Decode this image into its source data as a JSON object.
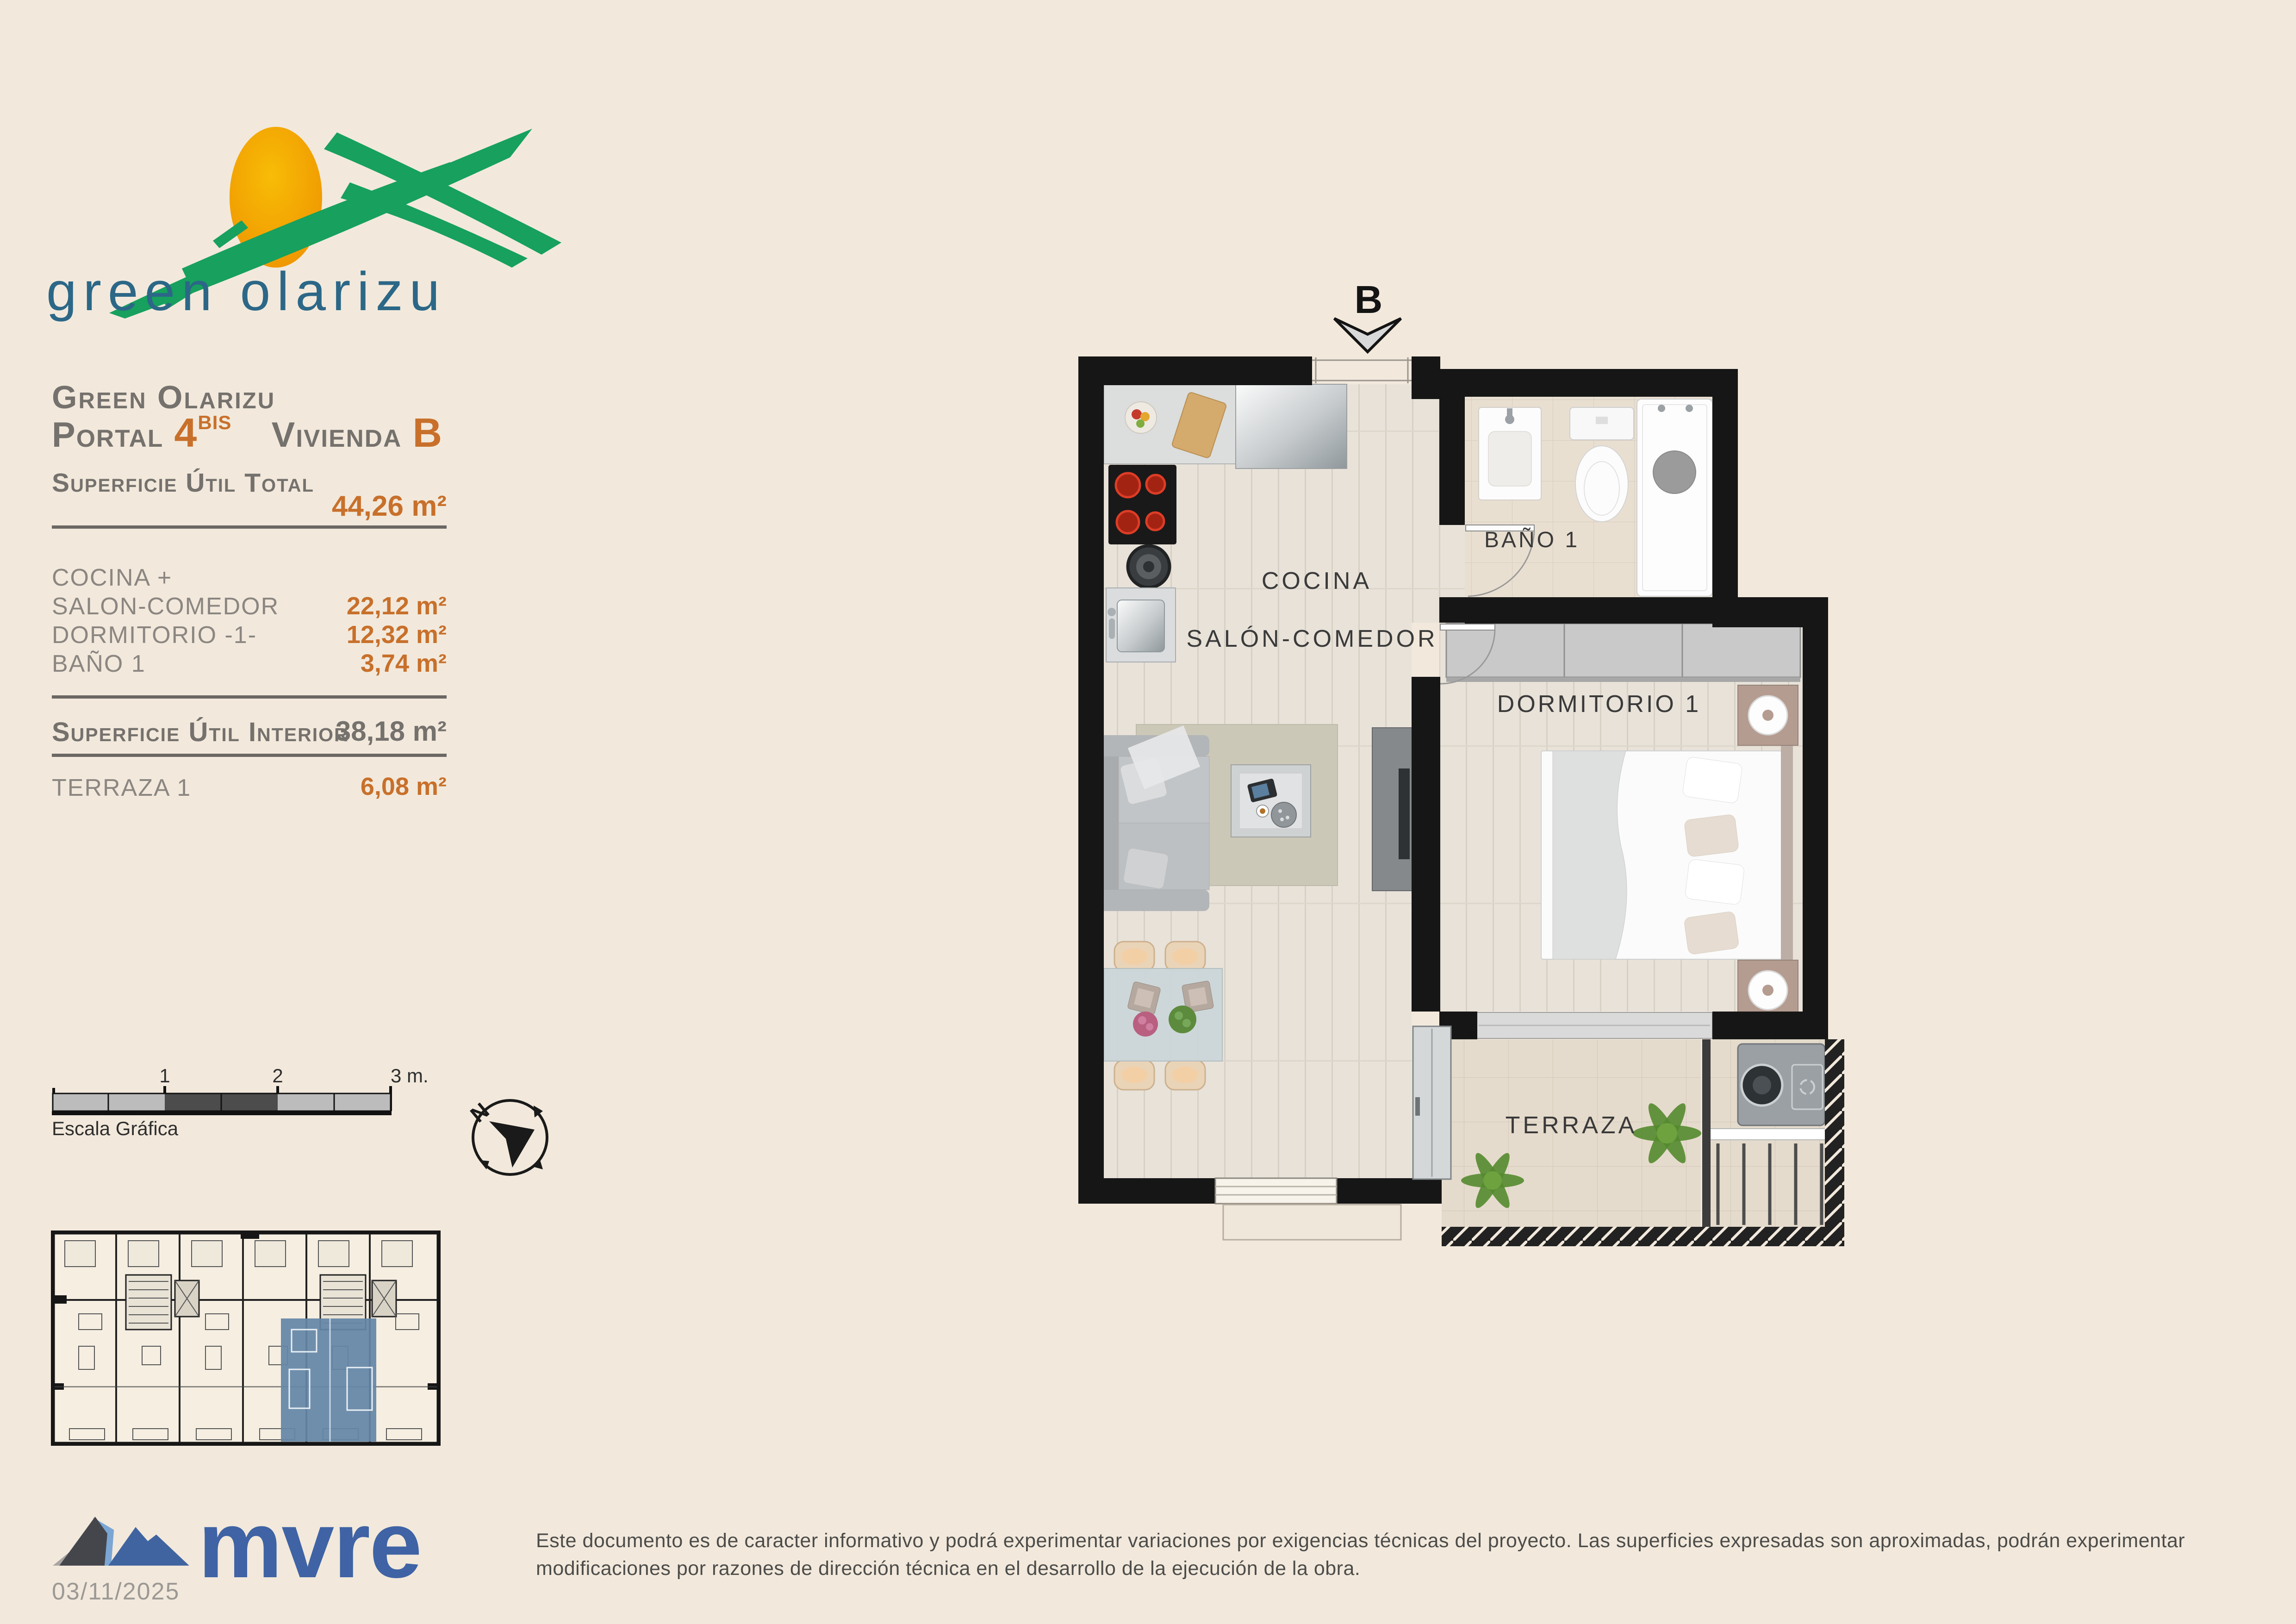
{
  "logo": {
    "text": "green olarizu"
  },
  "header": {
    "project": "Green Olarizu",
    "portal_label": "Portal",
    "portal_number": "4",
    "portal_suffix": "BIS",
    "vivienda_label": "Vivienda",
    "vivienda_letter": "B"
  },
  "areas": {
    "total_label": "Superficie Útil Total",
    "total_value": "44,26 m²",
    "rows": [
      {
        "label": "COCINA +",
        "value": ""
      },
      {
        "label": "SALON-COMEDOR",
        "value": "22,12 m²"
      },
      {
        "label": "DORMITORIO -1-",
        "value": "12,32 m²"
      },
      {
        "label": "BAÑO 1",
        "value": "3,74 m²"
      }
    ],
    "interior_label": "Superficie Útil Interior",
    "interior_value": "38,18 m²",
    "terraza_label": "TERRAZA 1",
    "terraza_value": "6,08 m²"
  },
  "scalebar": {
    "label": "Escala Gráfica",
    "tick1": "1",
    "tick2": "2",
    "tick3": "3 m."
  },
  "compass": {
    "north": "N"
  },
  "plan": {
    "entrance_marker": "B",
    "room_cocina": "COCINA",
    "room_salon": "SALÓN-COMEDOR",
    "room_bano": "BAÑO 1",
    "room_dormitorio": "DORMITORIO 1",
    "room_terraza": "TERRAZA"
  },
  "footer": {
    "brand": "mvre",
    "date": "03/11/2025",
    "disclaimer": "Este documento es de caracter informativo y podrá experimentar variaciones por exigencias técnicas del proyecto. Las superficies expresadas son aproximadas, podrán experimentar modificaciones por razones de dirección técnica en el desarrollo de la ejecución de la obra."
  },
  "colors": {
    "accent_orange": "#c8702b",
    "text_gray": "#75716d",
    "logo_green": "#17a05e",
    "logo_blue": "#2c6787",
    "brand_blue": "#3f63a4",
    "highlight_blue": "#6487a7",
    "page_background": "#f2e9dc"
  }
}
